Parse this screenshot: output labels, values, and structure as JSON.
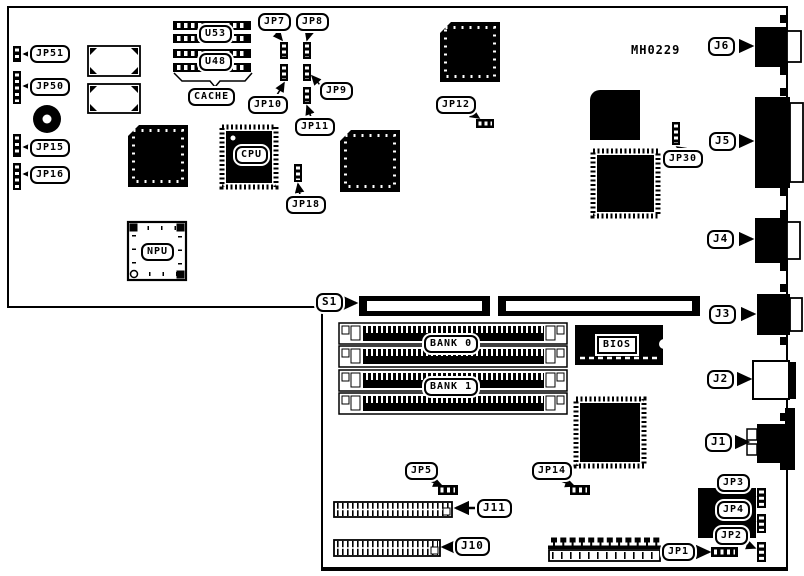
{
  "figure": {
    "type": "motherboard-jumper-connector-diagram",
    "board_marking": "MH0229",
    "colors": {
      "ink": "#000000",
      "background": "#ffffff"
    }
  },
  "labels": {
    "jp51": "JP51",
    "jp50": "JP50",
    "jp15": "JP15",
    "jp16": "JP16",
    "u53": "U53",
    "u48": "U48",
    "cache": "CACHE",
    "cpu": "CPU",
    "npu": "NPU",
    "jp7": "JP7",
    "jp8": "JP8",
    "jp9": "JP9",
    "jp10": "JP10",
    "jp11": "JP11",
    "jp18": "JP18",
    "jp12": "JP12",
    "jp30": "JP30",
    "board_marking": "MH0229",
    "j6": "J6",
    "j5": "J5",
    "j4": "J4",
    "j3": "J3",
    "j2": "J2",
    "j1": "J1",
    "s1": "S1",
    "bank0": "BANK 0",
    "bank1": "BANK 1",
    "bios": "BIOS",
    "jp5": "JP5",
    "jp14": "JP14",
    "j11": "J11",
    "j10": "J10",
    "jp1": "JP1",
    "jp3": "JP3",
    "jp4": "JP4",
    "jp2": "JP2"
  }
}
